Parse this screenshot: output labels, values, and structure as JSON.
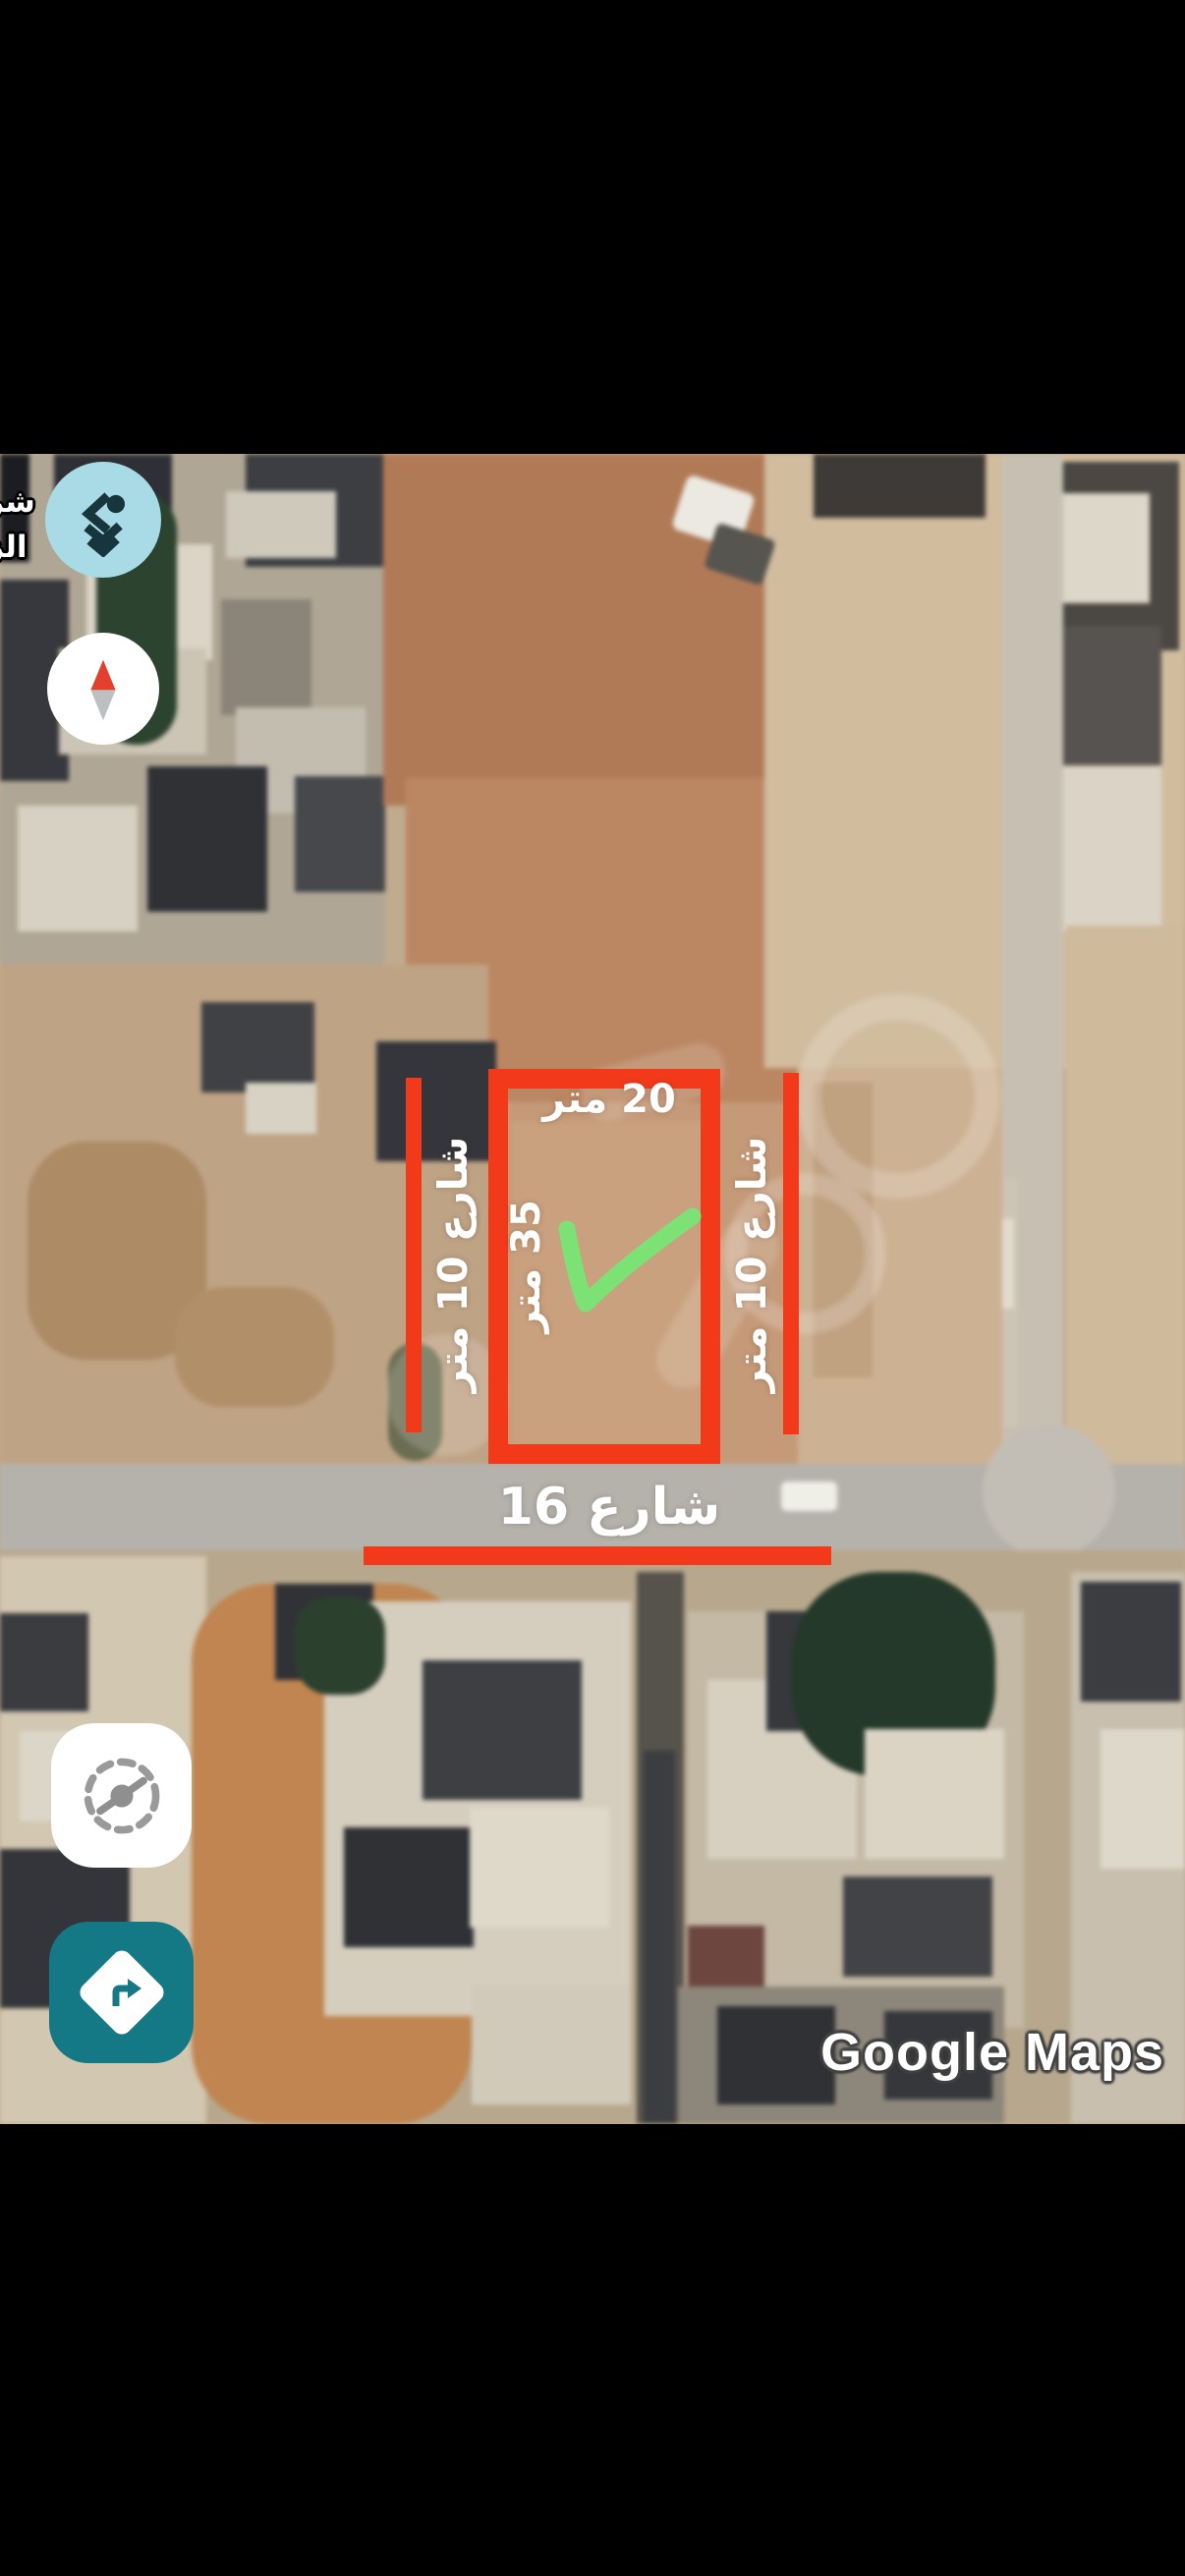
{
  "watermark": {
    "text": "Google Maps"
  },
  "street_sign_fragment": {
    "line1": "شر",
    "line2": "الز"
  },
  "annotations": {
    "plot_width_label": "20 متر",
    "plot_depth_label": "35 متر",
    "left_street_label": "شارع 10 متر",
    "right_street_label": "شارع 10 متر",
    "bottom_street_label": "شارع 16",
    "checkmark": "green-check"
  },
  "controls": {
    "logo_button": "app-logo",
    "compass_button": "compass-north",
    "calibrate_button": "compass-calibrate",
    "directions_button": "directions"
  },
  "colors": {
    "annotation_red": "#f23a1b",
    "check_green": "#7de276",
    "directions_teal": "#147885",
    "logo_blue": "#a9dbe7",
    "compass_needle_red": "#e2402c"
  }
}
